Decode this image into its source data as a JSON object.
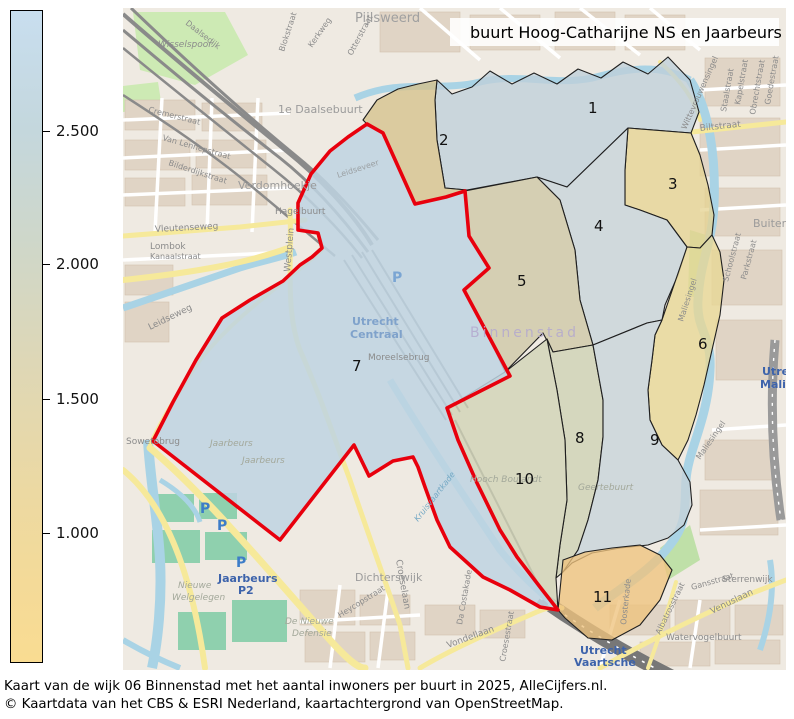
{
  "legend_colorbar": {
    "ticks": [
      "2.500",
      "2.000",
      "1.500",
      "1.000"
    ],
    "colors_top_to_bottom": [
      "#c8deef",
      "#c4d7dd",
      "#ded7b6",
      "#f9dc92"
    ]
  },
  "map_legend": {
    "swatch_color": "#ee0000",
    "label": "buurt Hoog-Catharijne NS en Jaarbeurs"
  },
  "caption": {
    "line1": "Kaart van de wijk 06 Binnenstad met het aantal inwoners per buurt in 2025, AlleCijfers.nl.",
    "line2": "© Kaartdata van het CBS & ESRI Nederland, kaartachtergrond van OpenStreetMap."
  },
  "map": {
    "selected_outline_color": "#e8000d",
    "parking_label": "P",
    "regions": [
      {
        "number": "1",
        "color": "#bfd0da"
      },
      {
        "number": "2",
        "color": "#d5c28c"
      },
      {
        "number": "3",
        "color": "#e6d493"
      },
      {
        "number": "4",
        "color": "#c7d4da"
      },
      {
        "number": "5",
        "color": "#cdc7a5"
      },
      {
        "number": "6",
        "color": "#e8d795"
      },
      {
        "number": "7",
        "color": "#bed3e2"
      },
      {
        "number": "8",
        "color": "#cdd1b3"
      },
      {
        "number": "9",
        "color": "#c6d4da"
      },
      {
        "number": "10",
        "color": "#cfd2b5"
      },
      {
        "number": "11",
        "color": "#eec37d"
      }
    ],
    "place_labels": [
      {
        "text": "Pijlsweerd"
      },
      {
        "text": "Wisselspoor"
      },
      {
        "text": "Daalsedijk"
      },
      {
        "text": "Blokstraat"
      },
      {
        "text": "Kerkweg"
      },
      {
        "text": "Otterstraat"
      },
      {
        "text": "1e Daalsebuurt"
      },
      {
        "text": "Cremerstraat"
      },
      {
        "text": "Van Lennepstraat"
      },
      {
        "text": "Bilderdijkstraat"
      },
      {
        "text": "Verdomhoekje"
      },
      {
        "text": "Hagelbuurt"
      },
      {
        "text": "Vleutenseweg"
      },
      {
        "text": "Kanaalstraat"
      },
      {
        "text": "Lombok"
      },
      {
        "text": "Westplein"
      },
      {
        "text": "Leidseweg"
      },
      {
        "text": "Leidseveer"
      },
      {
        "text": "Sowetobrug"
      },
      {
        "text": "Jaarbeurs"
      },
      {
        "text": "Jaarbeurs"
      },
      {
        "text": "Nieuwe"
      },
      {
        "text": "Welgelegen"
      },
      {
        "text": "Dichterswijk"
      },
      {
        "text": "De Nieuwe"
      },
      {
        "text": "Defensie"
      },
      {
        "text": "Croeselaan"
      },
      {
        "text": "Heycopstraat"
      },
      {
        "text": "Da Costakade"
      },
      {
        "text": "Croesestraat"
      },
      {
        "text": "Vondellaan"
      },
      {
        "text": "Watervogelbuurt"
      },
      {
        "text": "Sterrenwijk"
      },
      {
        "text": "Venuslaan"
      },
      {
        "text": "Albatrosstraat"
      },
      {
        "text": "Oosterkade"
      },
      {
        "text": "Gansstraat"
      },
      {
        "text": "Maliesingel"
      },
      {
        "text": "Maliesingel"
      },
      {
        "text": "Schoolstraat"
      },
      {
        "text": "Parkstraat"
      },
      {
        "text": "Biltstraat"
      },
      {
        "text": "Wittevrouwensingel"
      },
      {
        "text": "Staalstraat"
      },
      {
        "text": "Kapelstraat"
      },
      {
        "text": "Obrechtstraat"
      },
      {
        "text": "Goedestraat"
      },
      {
        "text": "Buiten Wittevrouwen"
      },
      {
        "text": "Moreelsebrug"
      },
      {
        "text": "Binnenstad"
      },
      {
        "text": "Hooch Boulandt"
      },
      {
        "text": "Geertebuurt"
      },
      {
        "text": "Kruisvaartkade"
      }
    ],
    "station_labels": {
      "centraal": {
        "line1": "Utrecht",
        "line2": "Centraal"
      },
      "vaartsche_rijn": {
        "line1": "Utrecht",
        "line2": "Vaartsche",
        "line3": "Rijn"
      },
      "maliebaan": {
        "line1": "Utrecht",
        "line2": "Maliebaan"
      },
      "jaarbeurs_p2": {
        "line1": "Jaarbeurs",
        "line2": "P2"
      }
    }
  }
}
